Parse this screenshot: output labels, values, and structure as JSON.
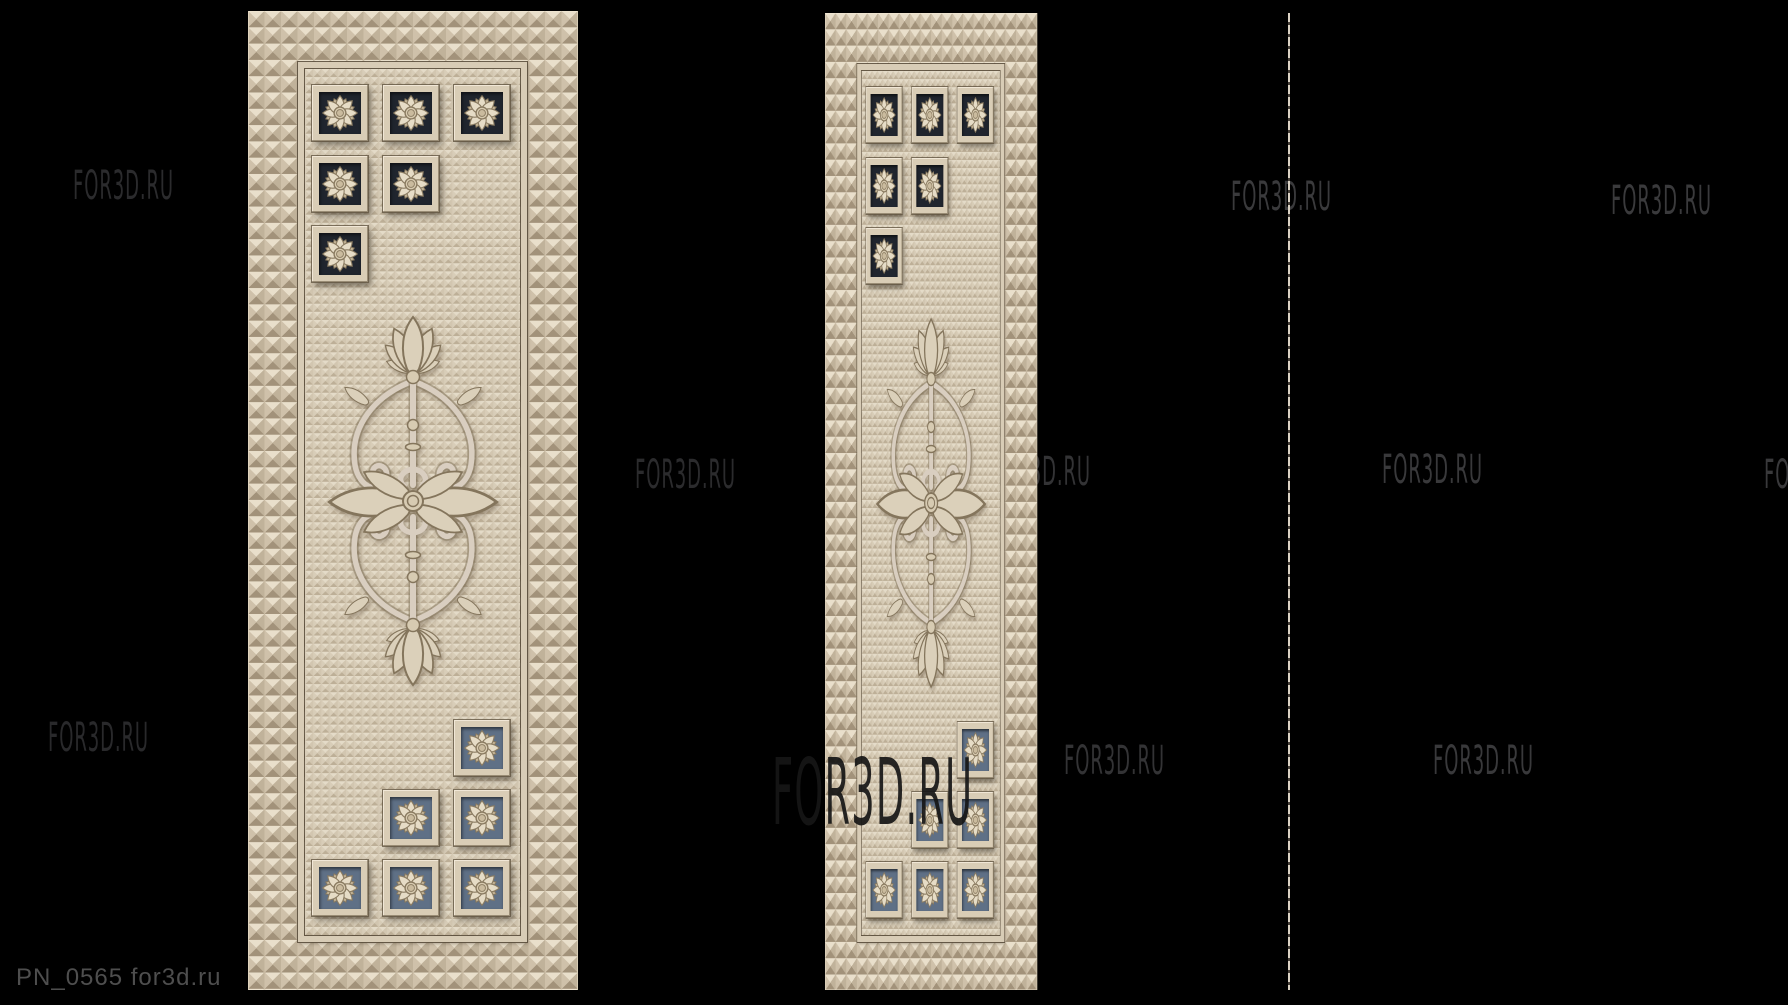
{
  "scene": {
    "width": 1788,
    "height": 1005,
    "background": "#000000",
    "watermark_text": "FOR3D.RU",
    "label": {
      "text": "PN_0565 for3d.ru",
      "x": 16,
      "y": 966,
      "font_size": 24,
      "color": "#4e4e4e"
    },
    "watermark_big": {
      "x": 772,
      "y": 747,
      "font_size": 92,
      "color": "#161616",
      "opacity": 0.92
    },
    "watermarks_small": [
      {
        "x": 73,
        "y": 166,
        "color": "#2b2b2d",
        "opacity": 1
      },
      {
        "x": 48,
        "y": 718,
        "color": "#29292b",
        "opacity": 1
      },
      {
        "x": 635,
        "y": 455,
        "color": "#2b2b2d",
        "opacity": 1
      },
      {
        "x": 990,
        "y": 452,
        "color": "#333335",
        "opacity": 1
      },
      {
        "x": 1064,
        "y": 741,
        "color": "#333335",
        "opacity": 1
      },
      {
        "x": 1231,
        "y": 177,
        "color": "#3a3a3c",
        "opacity": 1
      },
      {
        "x": 1382,
        "y": 450,
        "color": "#39393b",
        "opacity": 1
      },
      {
        "x": 1433,
        "y": 741,
        "color": "#39393b",
        "opacity": 1
      },
      {
        "x": 1611,
        "y": 181,
        "color": "#3a3a3c",
        "opacity": 1
      },
      {
        "x": 1764,
        "y": 455,
        "color": "#39393b",
        "opacity": 1
      }
    ],
    "edge_profile": {
      "x": 1288,
      "y": 13,
      "height": 977,
      "width": 2
    }
  },
  "panel_template": {
    "base_width": 330,
    "frame_inset": {
      "left": 50,
      "top": 51,
      "right": 51,
      "bottom": 48
    },
    "field_inset": {
      "left": 57,
      "top": 58,
      "right": 58,
      "bottom": 55
    },
    "tile_size": 56,
    "cols_x": [
      64,
      135,
      206
    ],
    "top_rows_y": [
      74,
      145,
      215
    ],
    "top_layout": [
      [
        0,
        1,
        2
      ],
      [
        0,
        1
      ],
      [
        0
      ]
    ],
    "bottom_rows_y": [
      709,
      779,
      849
    ],
    "bottom_layout": [
      [
        2
      ],
      [
        1,
        2
      ],
      [
        0,
        1,
        2
      ]
    ],
    "tile_bg_top": "#20252e",
    "tile_bg_bottom": "#5f7086",
    "ornament": {
      "x": 77,
      "y": 270,
      "width": 176,
      "height": 440
    }
  },
  "panels": [
    {
      "name": "door-panel-left",
      "x": 248,
      "y": 11,
      "height": 979,
      "scale_x": 1
    },
    {
      "name": "door-panel-right",
      "x": 825,
      "y": 13,
      "height": 977,
      "scale_x": 0.643
    }
  ]
}
